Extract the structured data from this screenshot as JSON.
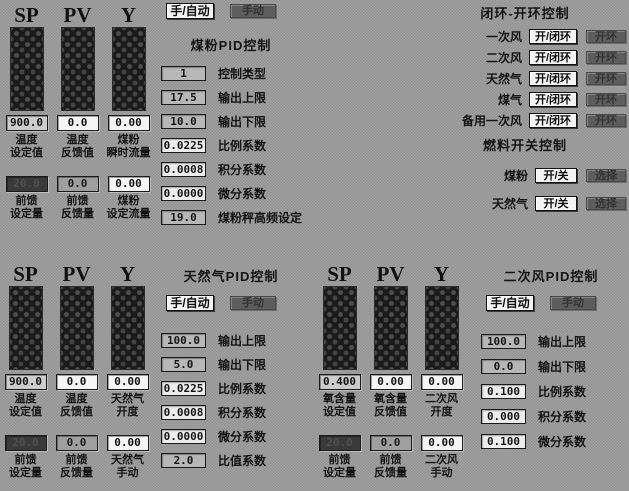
{
  "colors": {
    "background": "#9a9a9a",
    "bar_dark": "#1b1b1b",
    "box_light": "#f5f5f5",
    "box_gray": "#b7b7b7",
    "box_dark": "#3a3a3a",
    "button_light": "#f3f3f3",
    "button_dark": "#5d5d5d",
    "text": "#141414"
  },
  "coal_gauges": {
    "columns": [
      "SP",
      "PV",
      "Y"
    ],
    "values": [
      "900.0",
      "0.0",
      "0.00"
    ],
    "value_labels": [
      "温度\n设定值",
      "温度\n反馈值",
      "煤粉\n瞬时流量"
    ],
    "ff_values": [
      "20.0",
      "0.0",
      "0.00"
    ],
    "ff_labels": [
      "前馈\n设定量",
      "前馈\n反馈量",
      "煤粉\n设定流量"
    ]
  },
  "coal_pid": {
    "title": "煤粉PID控制",
    "manual_auto_button": "手/自动",
    "manual_button": "手动",
    "fields": [
      {
        "value": "1",
        "label": "控制类型"
      },
      {
        "value": "17.5",
        "label": "输出上限"
      },
      {
        "value": "10.0",
        "label": "输出下限"
      },
      {
        "value": "0.0225",
        "label": "比例系数"
      },
      {
        "value": "0.0008",
        "label": "积分系数"
      },
      {
        "value": "0.0000",
        "label": "微分系数"
      },
      {
        "value": "19.0",
        "label": "煤粉秤高频设定"
      }
    ]
  },
  "loop_control": {
    "title": "闭环-开环控制",
    "rows": [
      {
        "label": "一次风",
        "toggle": "开/闭环",
        "status": "开环"
      },
      {
        "label": "二次风",
        "toggle": "开/闭环",
        "status": "开环"
      },
      {
        "label": "天然气",
        "toggle": "开/闭环",
        "status": "开环"
      },
      {
        "label": "煤气",
        "toggle": "开/闭环",
        "status": "开环"
      },
      {
        "label": "备用一次风",
        "toggle": "开/闭环",
        "status": "开环"
      }
    ]
  },
  "fuel_control": {
    "title": "燃料开关控制",
    "rows": [
      {
        "label": "煤粉",
        "toggle": "开/关",
        "action": "选择"
      },
      {
        "label": "天然气",
        "toggle": "开/关",
        "action": "选择"
      }
    ]
  },
  "gas_gauges": {
    "columns": [
      "SP",
      "PV",
      "Y"
    ],
    "values": [
      "900.0",
      "0.0",
      "0.00"
    ],
    "value_labels": [
      "温度\n设定值",
      "温度\n反馈值",
      "天然气\n开度"
    ],
    "ff_values": [
      "20.0",
      "0.0",
      "0.00"
    ],
    "ff_labels": [
      "前馈\n设定量",
      "前馈\n反馈量",
      "天然气\n手动"
    ]
  },
  "gas_pid": {
    "title": "天然气PID控制",
    "manual_auto_button": "手/自动",
    "manual_button": "手动",
    "fields": [
      {
        "value": "100.0",
        "label": "输出上限"
      },
      {
        "value": "5.0",
        "label": "输出下限"
      },
      {
        "value": "0.0225",
        "label": "比例系数"
      },
      {
        "value": "0.0008",
        "label": "积分系数"
      },
      {
        "value": "0.0000",
        "label": "微分系数"
      },
      {
        "value": "2.0",
        "label": "比值系数"
      }
    ]
  },
  "air_gauges": {
    "columns": [
      "SP",
      "PV",
      "Y"
    ],
    "values": [
      "0.400",
      "0.00",
      "0.00"
    ],
    "value_labels": [
      "氧含量\n设定值",
      "氧含量\n反馈值",
      "二次风\n开度"
    ],
    "ff_values": [
      "20.0",
      "0.0",
      "0.00"
    ],
    "ff_labels": [
      "前馈\n设定量",
      "前馈\n反馈量",
      "二次风\n手动"
    ]
  },
  "air_pid": {
    "title": "二次风PID控制",
    "manual_auto_button": "手/自动",
    "manual_button": "手动",
    "fields": [
      {
        "value": "100.0",
        "label": "输出上限"
      },
      {
        "value": "0.0",
        "label": "输出下限"
      },
      {
        "value": "0.100",
        "label": "比例系数"
      },
      {
        "value": "0.000",
        "label": "积分系数"
      },
      {
        "value": "0.100",
        "label": "微分系数"
      }
    ]
  }
}
